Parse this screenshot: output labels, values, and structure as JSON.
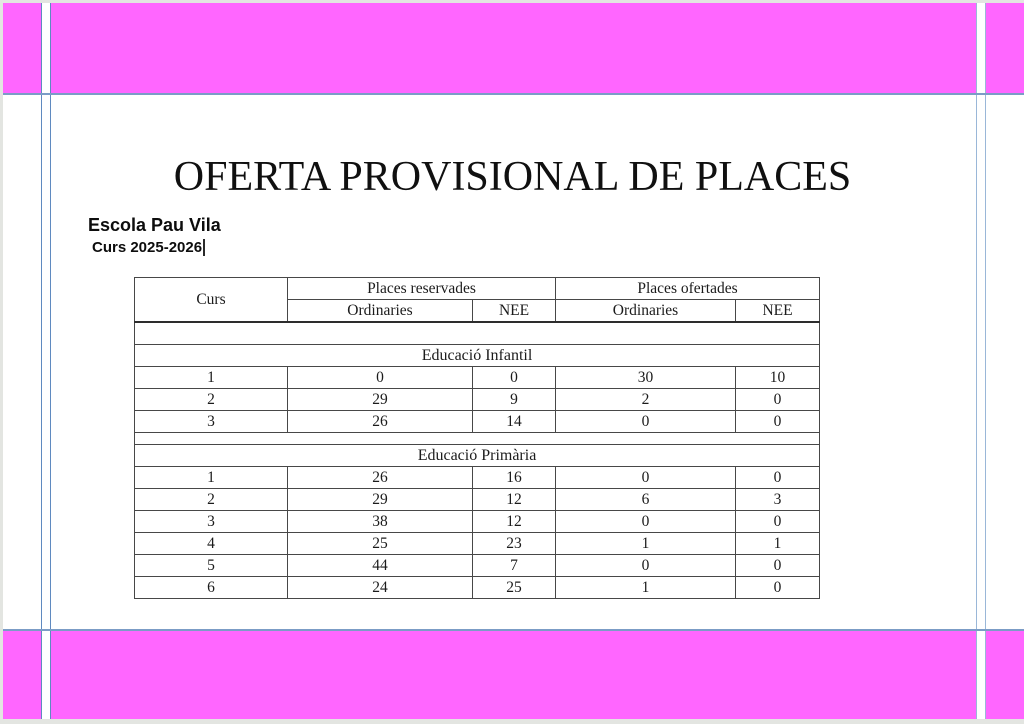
{
  "doc": {
    "title": "OFERTA PROVISIONAL DE PLACES",
    "school": "Escola Pau Vila",
    "course": "Curs 2025-2026"
  },
  "colors": {
    "band_magenta": "#ff66ff",
    "text_boundary_blue": "#5f8ac0",
    "table_border": "#474747"
  },
  "table": {
    "corner_header": "Curs",
    "group_headers": [
      "Places reservades",
      "Places ofertades"
    ],
    "sub_headers": [
      "Ordinaries",
      "NEE",
      "Ordinaries",
      "NEE"
    ],
    "sections": [
      {
        "label": "Educació Infantil",
        "rows": [
          [
            "1",
            "0",
            "0",
            "30",
            "10"
          ],
          [
            "2",
            "29",
            "9",
            "2",
            "0"
          ],
          [
            "3",
            "26",
            "14",
            "0",
            "0"
          ]
        ]
      },
      {
        "label": "Educació Primària",
        "rows": [
          [
            "1",
            "26",
            "16",
            "0",
            "0"
          ],
          [
            "2",
            "29",
            "12",
            "6",
            "3"
          ],
          [
            "3",
            "38",
            "12",
            "0",
            "0"
          ],
          [
            "4",
            "25",
            "23",
            "1",
            "1"
          ],
          [
            "5",
            "44",
            "7",
            "0",
            "0"
          ],
          [
            "6",
            "24",
            "25",
            "1",
            "0"
          ]
        ]
      }
    ]
  }
}
